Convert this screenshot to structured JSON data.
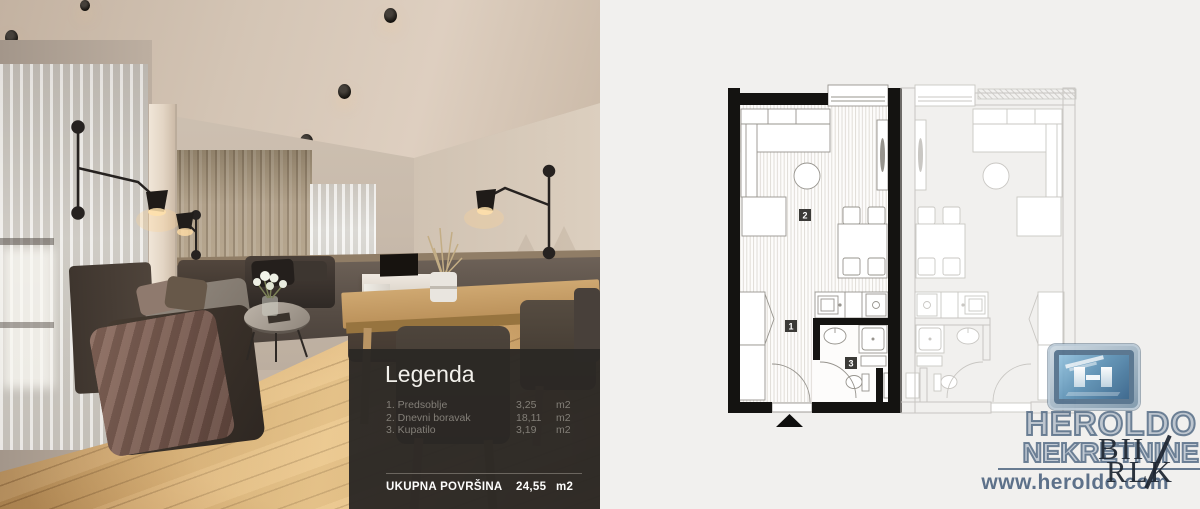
{
  "legend": {
    "title": "Legenda",
    "items": [
      {
        "name": "1. Predsoblje",
        "value": "3,25",
        "unit": "m2"
      },
      {
        "name": "2. Dnevni boravak",
        "value": "18,11",
        "unit": "m2"
      },
      {
        "name": "3. Kupatilo",
        "value": "3,19",
        "unit": "m2"
      }
    ],
    "total_label": "UKUPNA POVRŠINA",
    "total_value": "24,55",
    "total_unit": "m2"
  },
  "floorplan": {
    "labels": {
      "hallway": "1",
      "living": "2",
      "bathroom": "3"
    }
  },
  "branding": {
    "name": "HEROLDO",
    "subtitle": "NEKRETNINE",
    "website": "www.heroldo.com",
    "watermark": {
      "line1": "BII",
      "line2": "RLK"
    },
    "colors": {
      "logo_blue": "#53718c",
      "text_blue": "#58708d",
      "plan_wall": "#141311",
      "legend_bg": "#2b2825"
    }
  }
}
